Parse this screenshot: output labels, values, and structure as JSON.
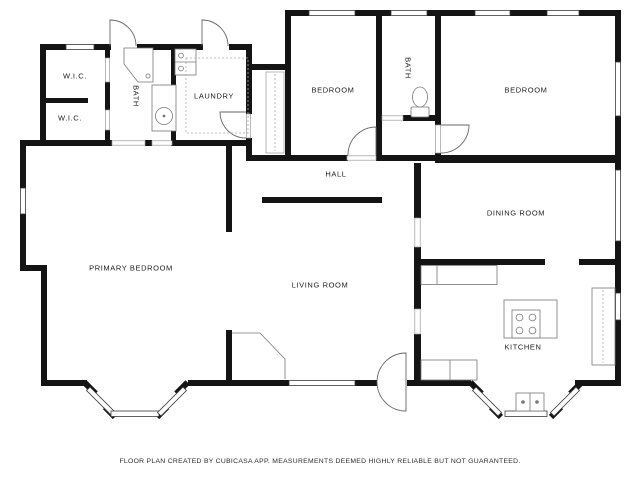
{
  "plan": {
    "rooms": [
      {
        "id": "wic-upper",
        "label": "W.I.C."
      },
      {
        "id": "wic-lower",
        "label": "W.I.C."
      },
      {
        "id": "bath-primary",
        "label": "BATH"
      },
      {
        "id": "laundry",
        "label": "LAUNDRY"
      },
      {
        "id": "bedroom-front",
        "label": "BEDROOM"
      },
      {
        "id": "bath-hall",
        "label": "BATH"
      },
      {
        "id": "bedroom-right",
        "label": "BEDROOM"
      },
      {
        "id": "hall",
        "label": "HALL"
      },
      {
        "id": "dining-room",
        "label": "DINING ROOM"
      },
      {
        "id": "primary-bedroom",
        "label": "PRIMARY BEDROOM"
      },
      {
        "id": "living-room",
        "label": "LIVING ROOM"
      },
      {
        "id": "kitchen",
        "label": "KITCHEN"
      }
    ],
    "fixtures": [
      "toilet-icon",
      "vanity-sink-icon",
      "corner-shower-icon",
      "washer-dryer-icon",
      "stove-island-icon",
      "kitchen-sink-icon",
      "fireplace-icon",
      "bay-window",
      "door-arc",
      "window"
    ],
    "caption": "FLOOR PLAN CREATED BY CUBICASA APP. MEASUREMENTS DEEMED HIGHLY RELIABLE BUT NOT GUARANTEED.",
    "colors": {
      "wall": "#141414",
      "fixture_line": "#777777",
      "door_line": "#666666",
      "label_text": "#1c1c1c",
      "background": "#ffffff"
    }
  }
}
